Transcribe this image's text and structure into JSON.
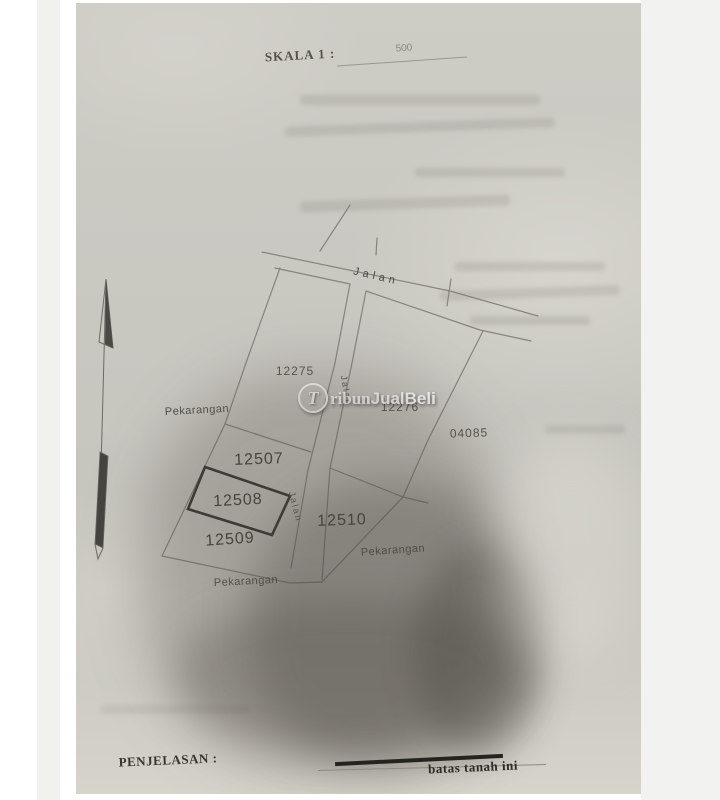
{
  "header": {
    "scale_label": "SKALA 1 :",
    "scale_value": "500"
  },
  "map": {
    "highlighted_plot": "12508",
    "roads": {
      "top": {
        "label": "Jalan"
      },
      "vertical_upper": {
        "label": "Jalan"
      },
      "vertical_lower": {
        "label": "Jalan"
      }
    },
    "plots": {
      "p12275": {
        "label": "12275"
      },
      "p12276": {
        "label": "12276"
      },
      "p04085": {
        "label": "04085"
      },
      "p12507": {
        "label": "12507"
      },
      "p12508": {
        "label": "12508"
      },
      "p12509": {
        "label": "12509"
      },
      "p12510": {
        "label": "12510"
      }
    },
    "land_use": {
      "left": {
        "label": "Pekarangan"
      },
      "right": {
        "label": "Pekarangan"
      },
      "bottom": {
        "label": "Pekarangan"
      }
    }
  },
  "watermark": {
    "initial": "T",
    "serif_part": "ribun",
    "bold_part": "JualBeli"
  },
  "footer": {
    "label": "PENJELASAN :",
    "line_meaning": "batas tanah ini"
  },
  "colors": {
    "paper": "#c8c7c0",
    "map_line": "#85847d",
    "highlight_line": "#33322e",
    "label_text": "#4e4d47",
    "watermark_text": "#ffffff"
  }
}
